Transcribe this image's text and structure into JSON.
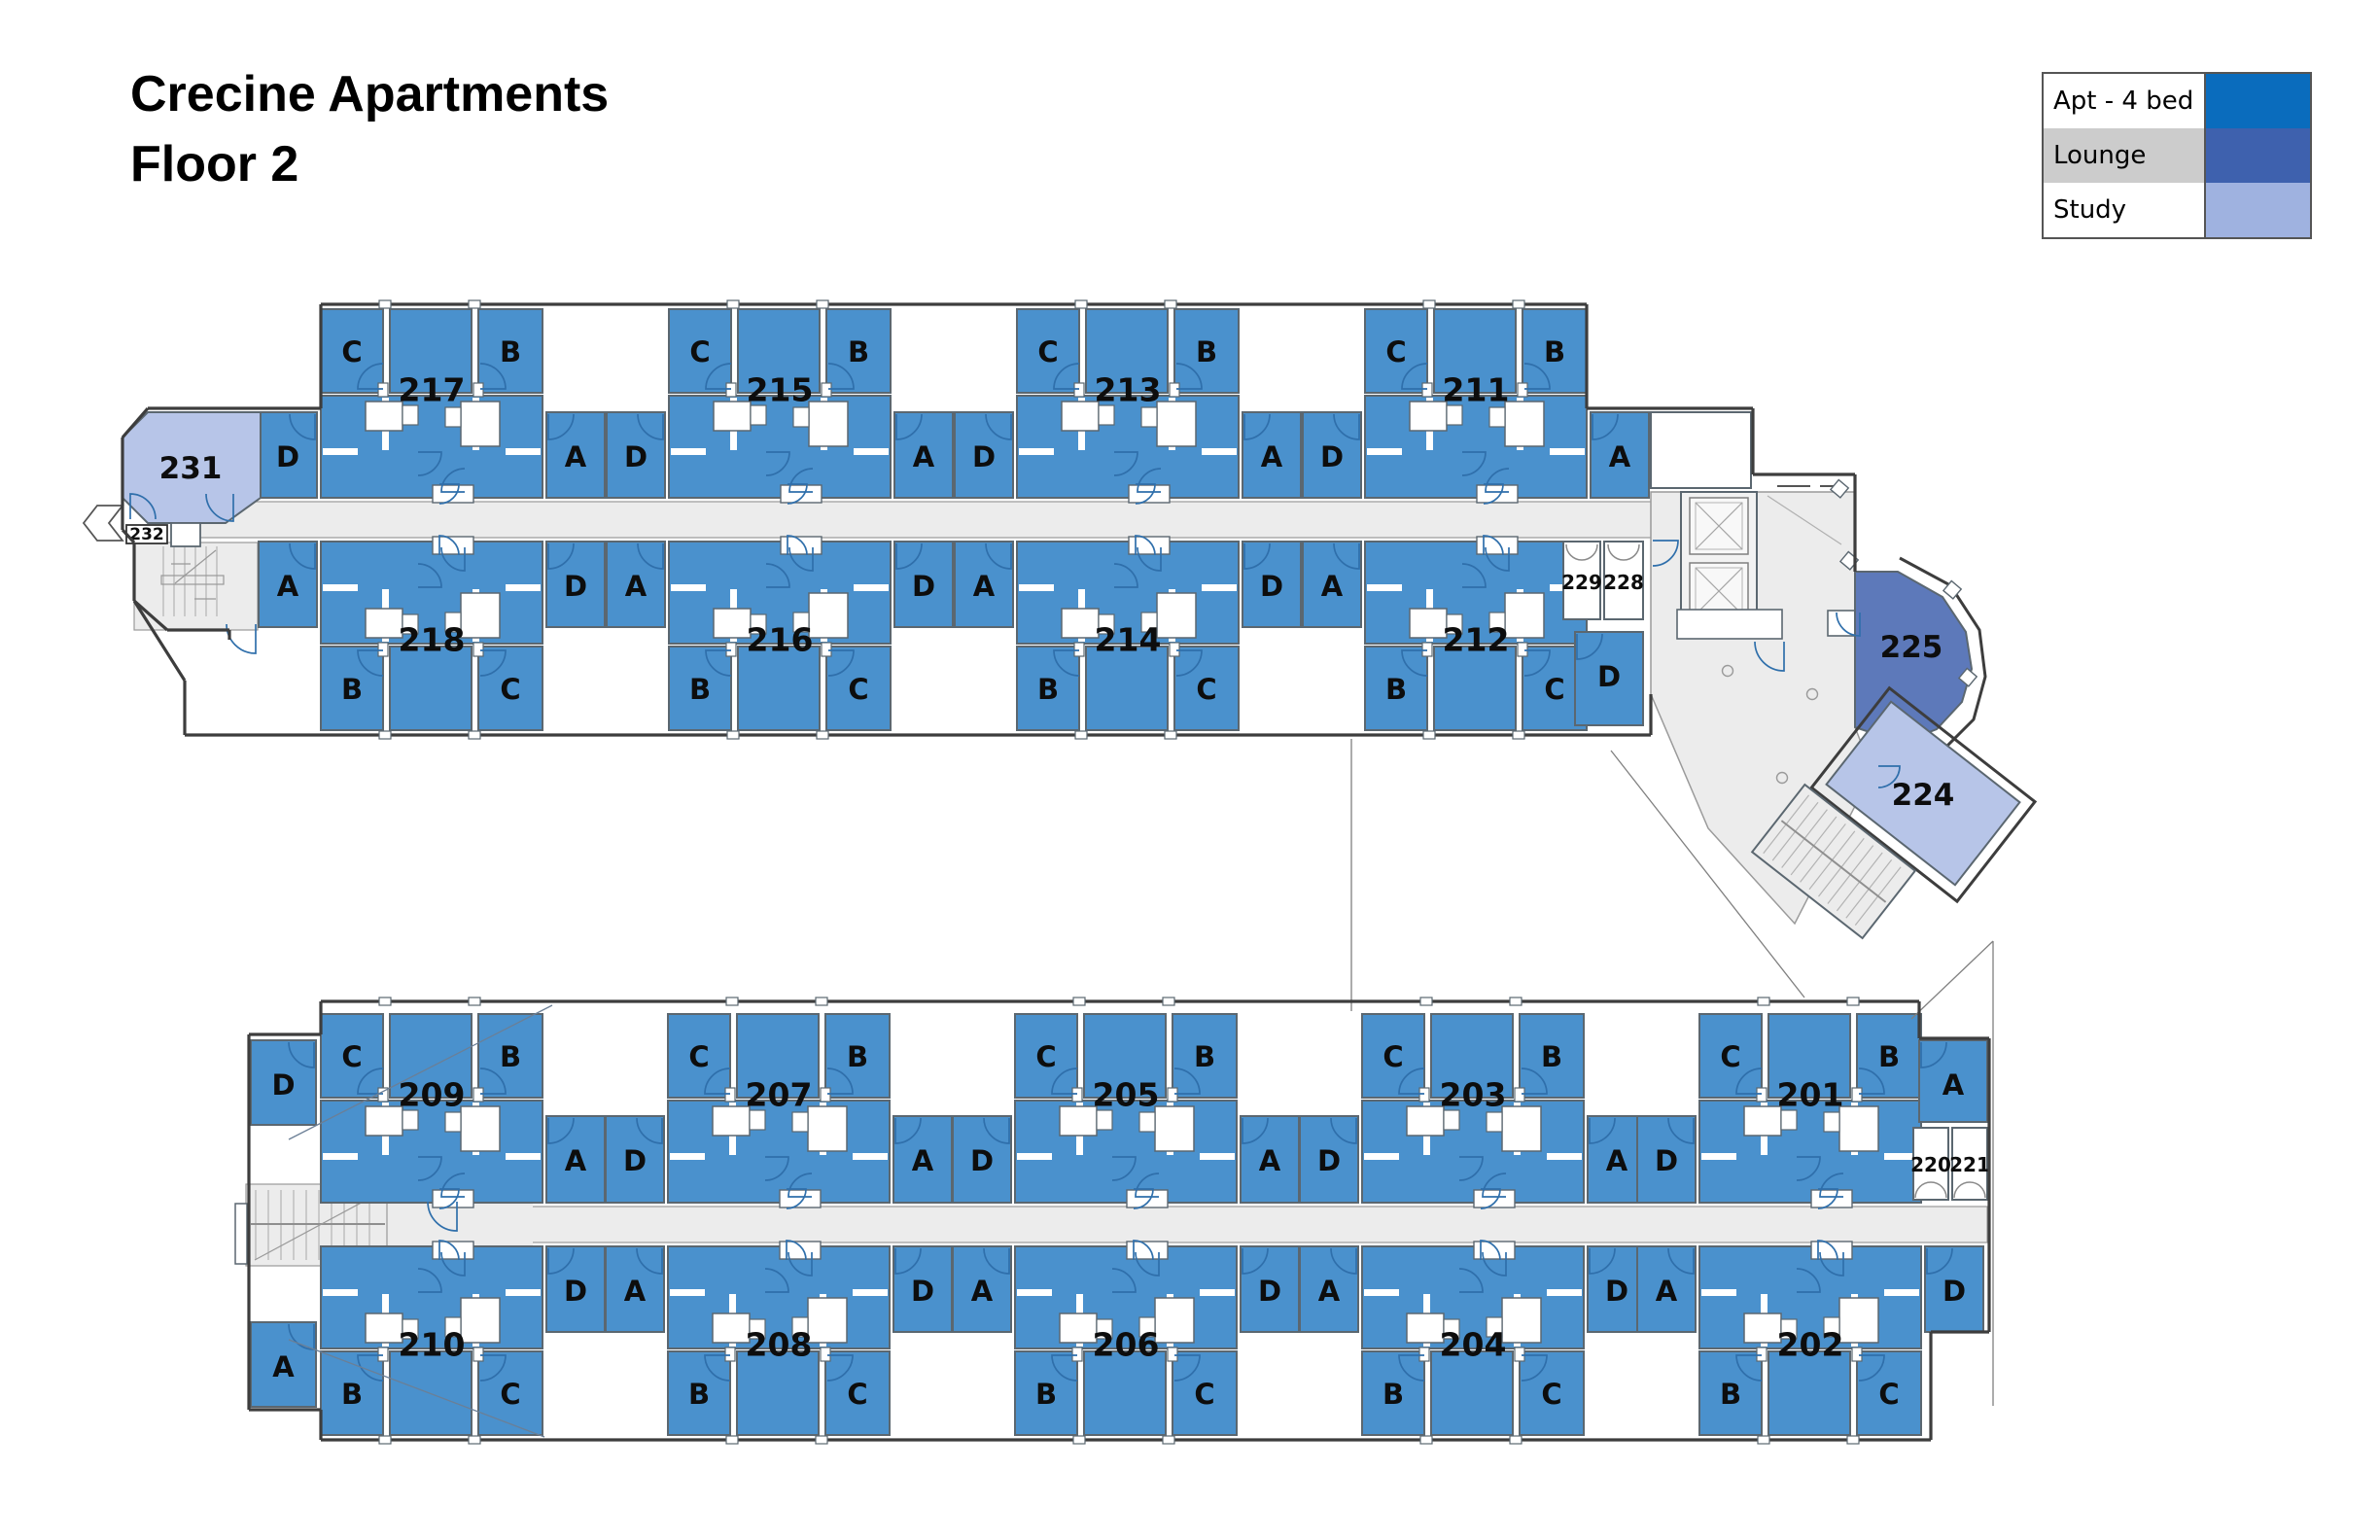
{
  "title": {
    "line1": "Crecine Apartments",
    "line2": "Floor 2"
  },
  "legend": {
    "rows": [
      {
        "label": "Apt - 4 bed",
        "swatch": "#0a6cbd",
        "bg": "#ffffff"
      },
      {
        "label": "Lounge",
        "swatch": "#3e61ae",
        "bg": "#cccccc"
      },
      {
        "label": "Study",
        "swatch": "#9fb2e0",
        "bg": "#ffffff"
      }
    ]
  },
  "colors": {
    "apt_room": "#4a91cd",
    "lounge_room": "#5d79ba",
    "study_room": "#b7c5e8",
    "floor": "#ececec",
    "wall": "#5b6770",
    "outer_wall": "#3d3d3d",
    "door_arc": "#2f6fab",
    "label_text": "#0d0d0d"
  },
  "wings": {
    "upper": {
      "top_row": [
        {
          "number": "217",
          "side_left": "D",
          "top_left": "C",
          "top_right": "B",
          "side_right": "A"
        },
        {
          "number": "215",
          "side_left": "D",
          "top_left": "C",
          "top_right": "B",
          "side_right": "A"
        },
        {
          "number": "213",
          "side_left": "D",
          "top_left": "C",
          "top_right": "B",
          "side_right": "A"
        },
        {
          "number": "211",
          "side_left": "D",
          "top_left": "C",
          "top_right": "B",
          "side_right": "A"
        }
      ],
      "bottom_row": [
        {
          "number": "218",
          "side_left": "A",
          "bottom_left": "B",
          "bottom_right": "C",
          "side_right": "D"
        },
        {
          "number": "216",
          "side_left": "A",
          "bottom_left": "B",
          "bottom_right": "C",
          "side_right": "D"
        },
        {
          "number": "214",
          "side_left": "A",
          "bottom_left": "B",
          "bottom_right": "C",
          "side_right": "D"
        },
        {
          "number": "212",
          "side_left": "A",
          "bottom_left": "B",
          "bottom_right": "C",
          "side_right": "D"
        }
      ]
    },
    "lower": {
      "top_row": [
        {
          "number": "209",
          "side_left": "D",
          "top_left": "C",
          "top_right": "B",
          "side_right": "A"
        },
        {
          "number": "207",
          "side_left": "D",
          "top_left": "C",
          "top_right": "B",
          "side_right": "A"
        },
        {
          "number": "205",
          "side_left": "D",
          "top_left": "C",
          "top_right": "B",
          "side_right": "A"
        },
        {
          "number": "203",
          "side_left": "D",
          "top_left": "C",
          "top_right": "B",
          "side_right": "A"
        },
        {
          "number": "201",
          "side_left": "D",
          "top_left": "C",
          "top_right": "B",
          "side_right": "A"
        }
      ],
      "bottom_row": [
        {
          "number": "210",
          "side_left": "A",
          "bottom_left": "B",
          "bottom_right": "C",
          "side_right": "D"
        },
        {
          "number": "208",
          "side_left": "A",
          "bottom_left": "B",
          "bottom_right": "C",
          "side_right": "D"
        },
        {
          "number": "206",
          "side_left": "A",
          "bottom_left": "B",
          "bottom_right": "C",
          "side_right": "D"
        },
        {
          "number": "204",
          "side_left": "A",
          "bottom_left": "B",
          "bottom_right": "C",
          "side_right": "D"
        },
        {
          "number": "202",
          "side_left": "A",
          "bottom_left": "B",
          "bottom_right": "C",
          "side_right": "D"
        }
      ]
    }
  },
  "rooms": {
    "study_upper_left": "231",
    "box_232": "232",
    "wc_229": "229",
    "wc_228": "228",
    "lounge": "225",
    "study_right": "224",
    "wc_220": "220",
    "wc_221": "221"
  }
}
